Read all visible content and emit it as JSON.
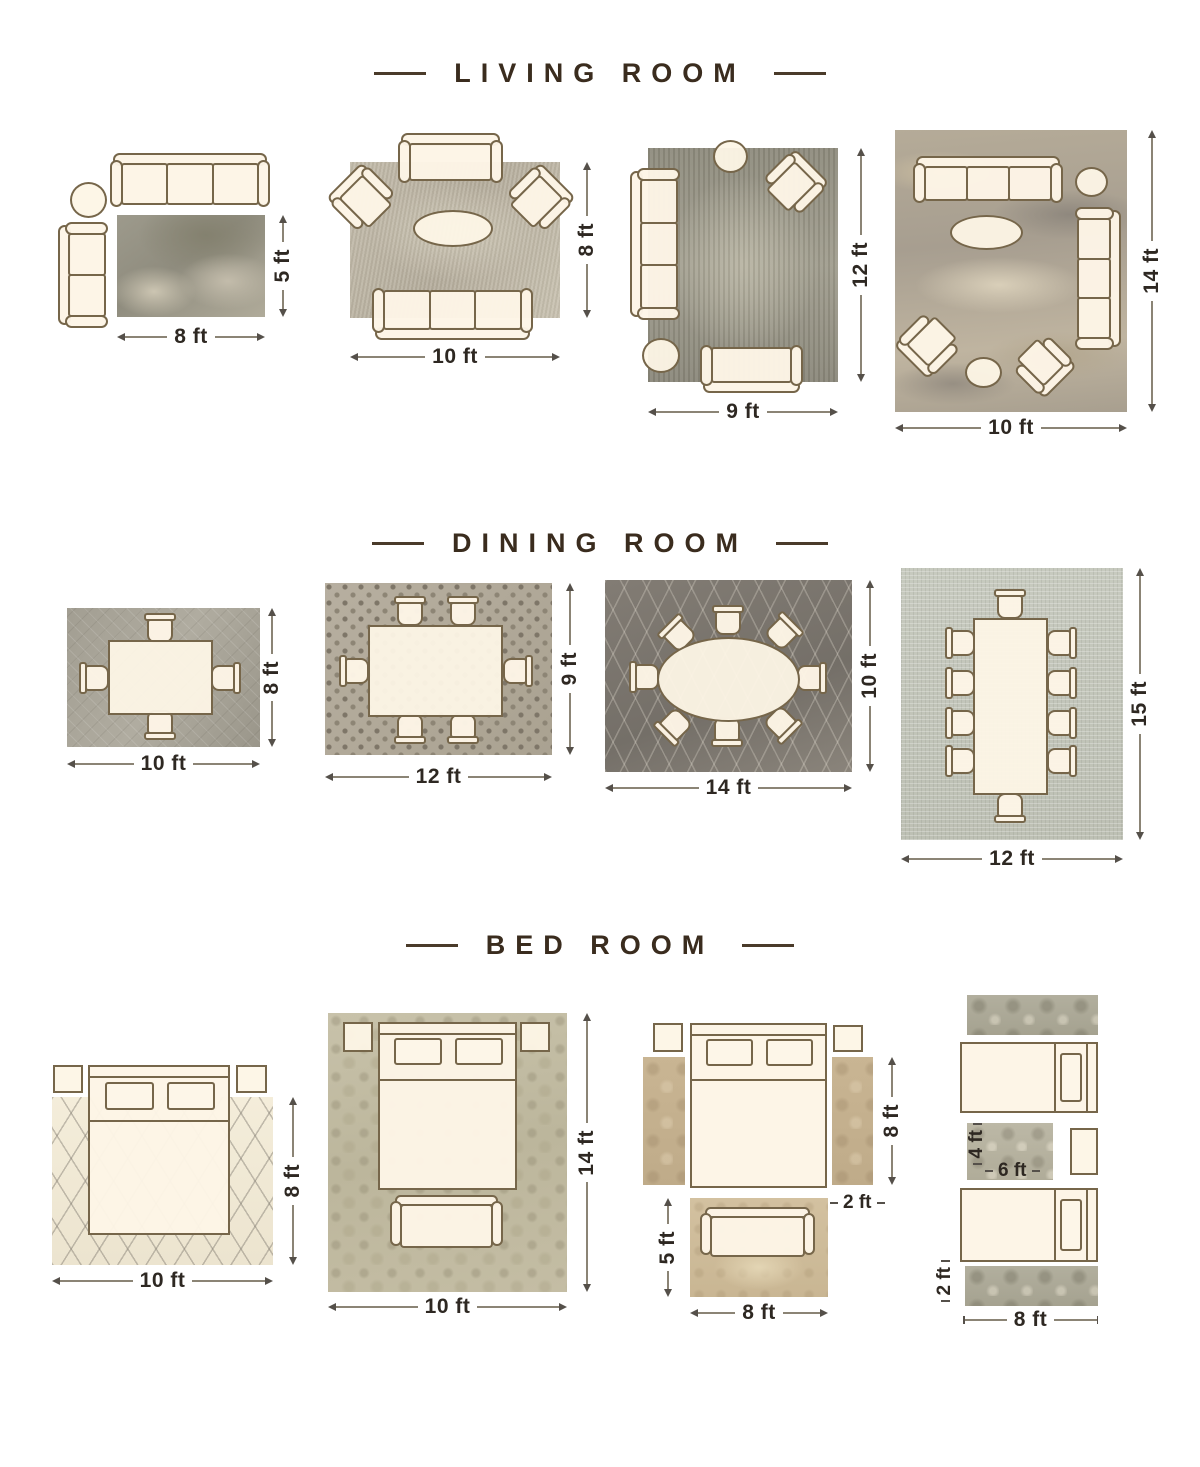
{
  "colors": {
    "background": "#ffffff",
    "title_text": "#3a2c1e",
    "dimension_text": "#2e2822",
    "dimension_line": "#8b8475",
    "furniture_fill": "#fdf5e6",
    "furniture_outline": "#76664a"
  },
  "sections": [
    {
      "title": "LIVING ROOM",
      "layouts": [
        {
          "width_label": "8 ft",
          "height_label": "5 ft",
          "furniture": [
            "three-seat-sofa",
            "loveseat",
            "round-side-table",
            "area-rug"
          ]
        },
        {
          "width_label": "10 ft",
          "height_label": "8 ft",
          "furniture": [
            "loveseat",
            "two-armchairs",
            "oval-coffee-table",
            "three-seat-sofa",
            "area-rug"
          ]
        },
        {
          "width_label": "9 ft",
          "height_label": "12 ft",
          "furniture": [
            "round-side-table",
            "armchair",
            "three-seat-sofa",
            "ottoman",
            "loveseat",
            "area-rug"
          ]
        },
        {
          "width_label": "10 ft",
          "height_label": "14 ft",
          "furniture": [
            "three-seat-sofa",
            "round-side-table",
            "three-seat-sofa",
            "oval-coffee-table",
            "two-armchairs",
            "ottoman",
            "area-rug"
          ]
        }
      ]
    },
    {
      "title": "DINING ROOM",
      "layouts": [
        {
          "width_label": "10 ft",
          "height_label": "8 ft",
          "furniture": [
            "dining-table",
            "four-chairs",
            "area-rug"
          ]
        },
        {
          "width_label": "12 ft",
          "height_label": "9 ft",
          "furniture": [
            "dining-table",
            "six-chairs",
            "area-rug"
          ]
        },
        {
          "width_label": "14 ft",
          "height_label": "10 ft",
          "furniture": [
            "oval-dining-table",
            "eight-chairs",
            "area-rug"
          ]
        },
        {
          "width_label": "12 ft",
          "height_label": "15 ft",
          "furniture": [
            "long-dining-table",
            "ten-chairs",
            "area-rug"
          ]
        }
      ]
    },
    {
      "title": "BED ROOM",
      "layouts": [
        {
          "width_label": "10 ft",
          "height_label": "8 ft",
          "furniture": [
            "queen-bed",
            "two-nightstands",
            "area-rug"
          ]
        },
        {
          "width_label": "10 ft",
          "height_label": "14 ft",
          "furniture": [
            "queen-bed",
            "two-nightstands",
            "bench",
            "area-rug"
          ]
        },
        {
          "runner_height_label": "8 ft",
          "runner_width_label": "2 ft",
          "foot_rug_height_label": "5 ft",
          "foot_rug_width_label": "8 ft",
          "furniture": [
            "queen-bed",
            "two-nightstands",
            "two-runner-rugs",
            "bench",
            "foot-rug"
          ]
        },
        {
          "center_rug_height_label": "4 ft",
          "center_rug_width_label": "6 ft",
          "runner_width_label": "2 ft",
          "runner_length_label": "8 ft",
          "furniture": [
            "two-twin-beds",
            "nightstand",
            "two-runner-rugs",
            "center-rug"
          ]
        }
      ]
    }
  ]
}
